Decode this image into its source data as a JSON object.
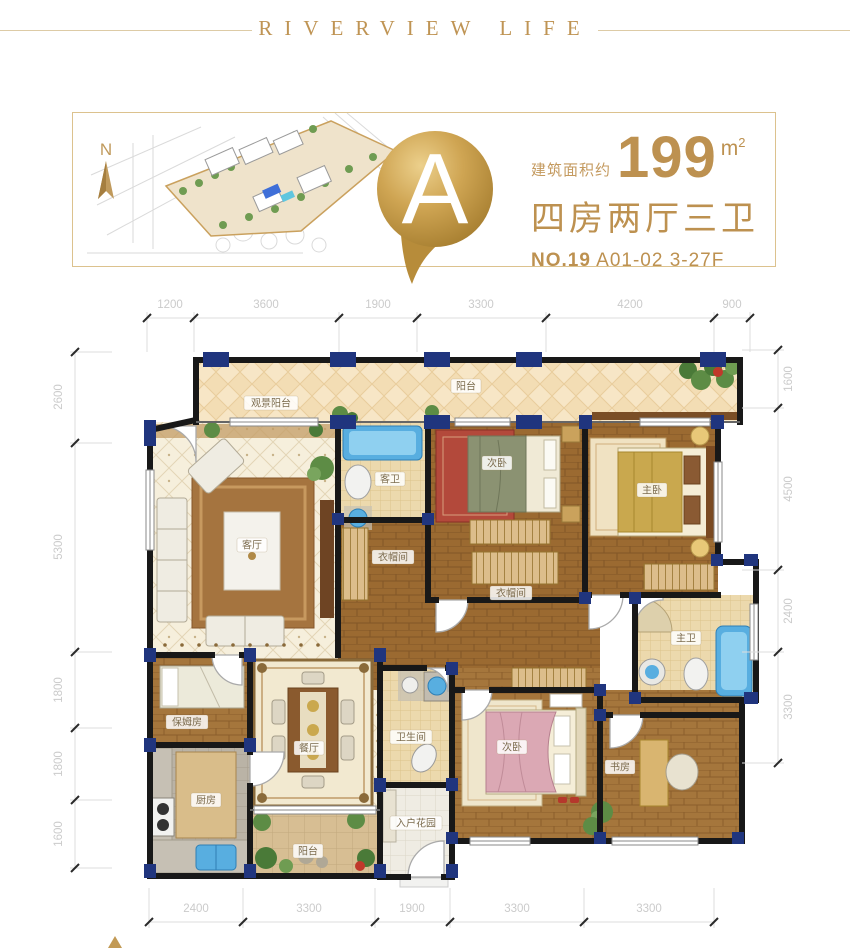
{
  "header": {
    "title": "RIVERVIEW LIFE"
  },
  "info": {
    "compass_label": "N",
    "unit_letter": "A",
    "area_prefix": "建筑面积约",
    "area_value": "199",
    "area_unit_base": "m",
    "area_unit_sup": "2",
    "layout_text": "四房两厅三卫",
    "unit_no": "NO.19",
    "unit_detail": "A01-02 3-27F"
  },
  "plan": {
    "dims_top": [
      "1200",
      "3600",
      "1900",
      "3300",
      "4200",
      "900"
    ],
    "dims_bottom": [
      "2400",
      "3300",
      "1900",
      "3300",
      "3300"
    ],
    "dims_left": [
      "2600",
      "5300",
      "1800",
      "1800",
      "1600"
    ],
    "dims_right": [
      "1600",
      "4500",
      "2400",
      "3300"
    ],
    "rooms": {
      "balcony_view": "观景阳台",
      "balcony": "阳台",
      "living": "客厅",
      "guest_bath": "客卫",
      "bedroom2": "次卧",
      "master": "主卧",
      "closet1": "衣帽间",
      "closet2": "衣帽间",
      "master_bath": "主卫",
      "study": "书房",
      "bedroom3": "次卧",
      "bath2": "卫生间",
      "entry": "入户花园",
      "dining": "餐厅",
      "kitchen": "厨房",
      "nanny": "保姆房",
      "patio": "阳台"
    }
  },
  "colors": {
    "gold": "#bd9150",
    "wall": "#181818",
    "column": "#20357e"
  }
}
